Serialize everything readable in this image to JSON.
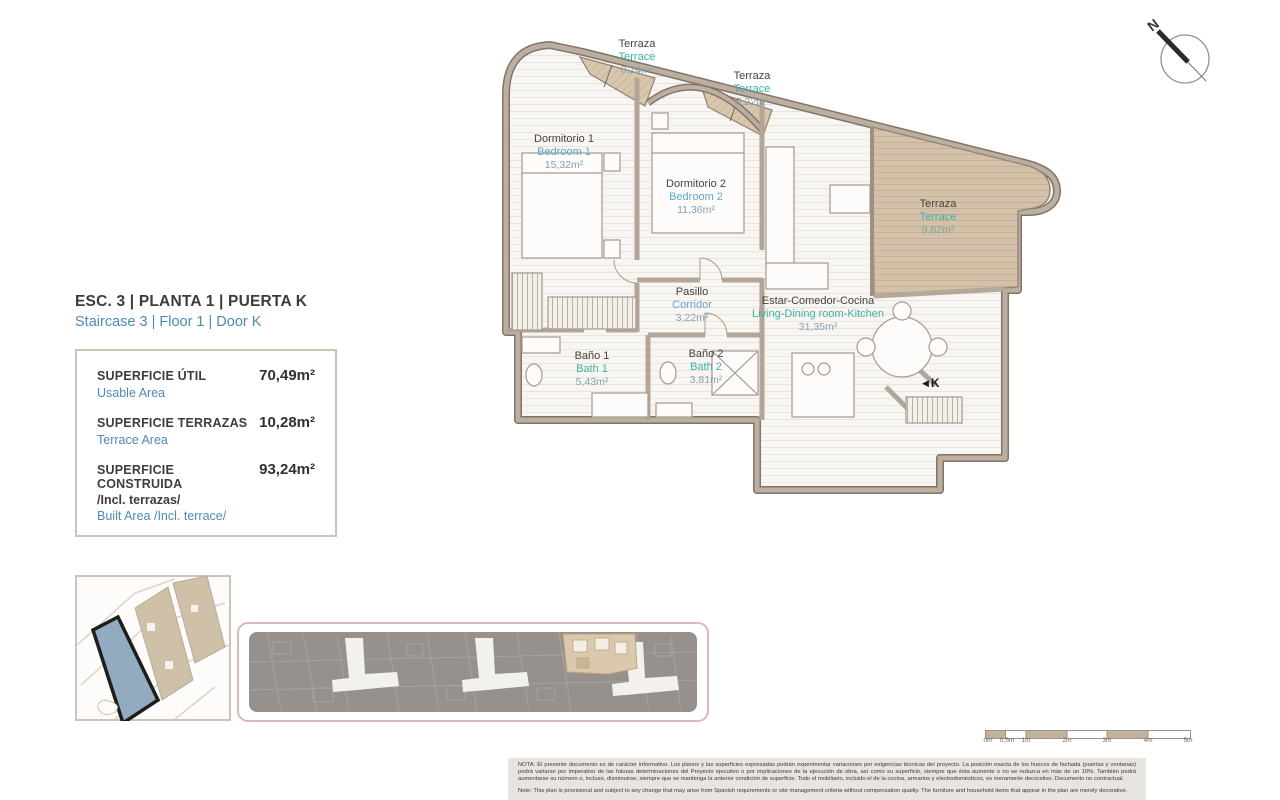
{
  "header": {
    "title_es": "ESC. 3 | PLANTA 1 | PUERTA K",
    "title_en": "Staircase 3 | Floor 1 | Door K"
  },
  "areas": {
    "rows": [
      {
        "label_es": "SUPERFICIE ÚTIL",
        "label_en": "Usable Area",
        "value": "70,49m²"
      },
      {
        "label_es": "SUPERFICIE TERRAZAS",
        "label_en": "Terrace Area",
        "value": "10,28m²"
      },
      {
        "label_es": "SUPERFICIE CONSTRUIDA",
        "label_es2": "/Incl. terrazas/",
        "label_en": "Built Area /Incl. terrace/",
        "value": "93,24m²"
      }
    ]
  },
  "rooms": [
    {
      "id": "terrace-top-1",
      "es": "Terraza",
      "en": "Terrace",
      "area": "0,24m²"
    },
    {
      "id": "terrace-top-2",
      "es": "Terraza",
      "en": "Terrace",
      "area": "0,22m²"
    },
    {
      "id": "bedroom-1",
      "es": "Dormitorio 1",
      "en": "Bedroom 1",
      "area": "15,32m²"
    },
    {
      "id": "bedroom-2",
      "es": "Dormitorio 2",
      "en": "Bedroom 2",
      "area": "11,36m²"
    },
    {
      "id": "terrace-main",
      "es": "Terraza",
      "en": "Terrace",
      "area": "9,82m²"
    },
    {
      "id": "corridor",
      "es": "Pasillo",
      "en": "Corridor",
      "area": "3,22m²"
    },
    {
      "id": "living",
      "es": "Estar-Comedor-Cocina",
      "en": "Living-Dining room-Kitchen",
      "area": "31,35m²"
    },
    {
      "id": "bath-1",
      "es": "Baño 1",
      "en": "Bath 1",
      "area": "5,43m²"
    },
    {
      "id": "bath-2",
      "es": "Baño 2",
      "en": "Bath 2",
      "area": "3,81m²"
    }
  ],
  "door_marker": {
    "arrow": "◀",
    "label": "K"
  },
  "compass": {
    "label": "N"
  },
  "scale_bar": {
    "labels": [
      "0m",
      "0,5m",
      "1m",
      "2m",
      "3m",
      "4m",
      "5m"
    ]
  },
  "disclaimer": {
    "es": "NOTA: El presente documento es de carácter informativo. Los planos y las superficies expresadas podrán experimentar variaciones por exigencias técnicas del proyecto. La posición exacta de los huecos de fachada (puertas y ventanas) podrá variarse por imperativo de las futuras determinaciones del Proyecto ejecutivo o por implicaciones de la ejecución de obra, así como su superficie, siempre que ésta aumente o no se reduzca en más de un 10%. También podrá aumentarse su número o, incluso, disminuirse, siempre que se mantenga la anterior condición de superficie. Todo el mobiliario, incluido el de la cocina, armarios y electrodomésticos, es meramente decorativo. Documento no contractual.",
    "en": "Note: This plan is provisional and subject to any change that may arise from Spanish requirements or site management criteria without compensation quality. The furniture and household items that appear in the plan are merely decorative."
  },
  "colors": {
    "accent_blue": "#4e8ab8",
    "label_blue": "#61a6d1",
    "label_teal": "#3eb1a5",
    "wall": "#b5a799",
    "terrace_fill": "#d3c2a9",
    "site_highlight": "#93abc0",
    "strip_fill": "#96918c",
    "strip_border": "#d9b9ba"
  }
}
